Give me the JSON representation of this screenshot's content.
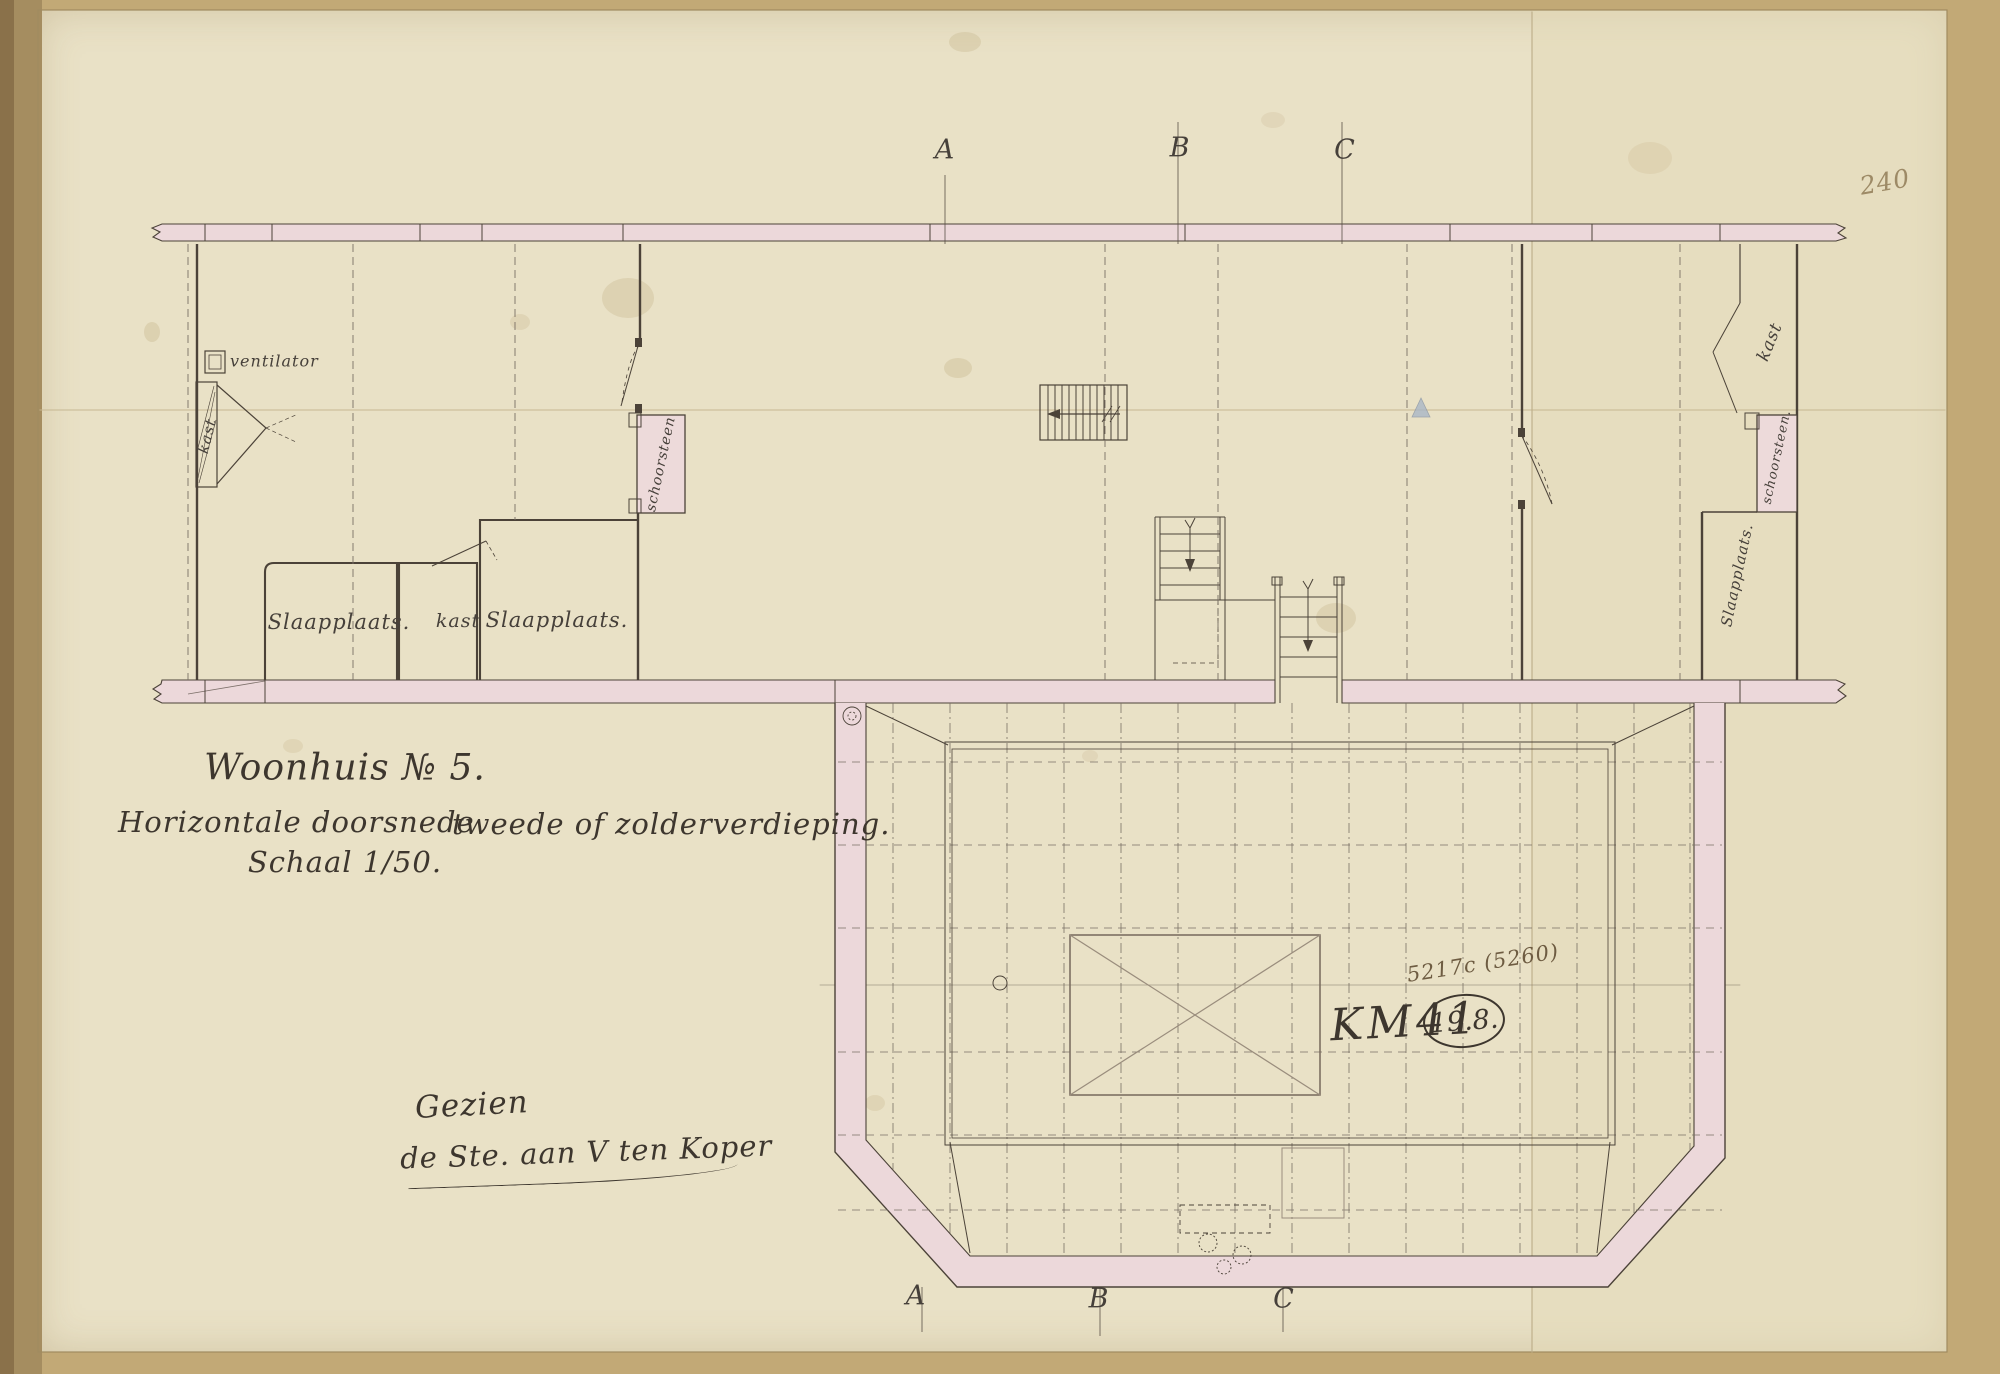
{
  "drawing": {
    "title": "Woonhuis № 5.",
    "subtitle_left": "Horizontale doorsnede",
    "subtitle_right": "tweede of zolderverdieping.",
    "scale_note": "Schaal 1/50.",
    "approval_line1": "Gezien",
    "approval_line2": "de Ste. aan V ten Koper"
  },
  "section_markers": {
    "top": [
      "A",
      "B",
      "C"
    ],
    "bottom": [
      "A",
      "B",
      "C"
    ]
  },
  "room_labels": {
    "ventilator": "ventilator",
    "kast_left": "kast",
    "slaapplaats_1": "Slaapplaats.",
    "kast_middle": "kast",
    "slaapplaats_2": "Slaapplaats.",
    "schoorsteen_left": "schoorsteen",
    "kast_right": "kast",
    "schoorsteen_right": "schoorsteen.",
    "slaapplaats_right": "Slaapplaats."
  },
  "annotations": {
    "page_number": "240",
    "inventory_number": "5217c (5260)",
    "collection_code": "KM41",
    "circled_number": "19.8."
  },
  "colors": {
    "paper": "#e9e1c6",
    "mat": "#c2a976",
    "wall_fill": "#ecd8da",
    "ink": "#4b4238"
  }
}
